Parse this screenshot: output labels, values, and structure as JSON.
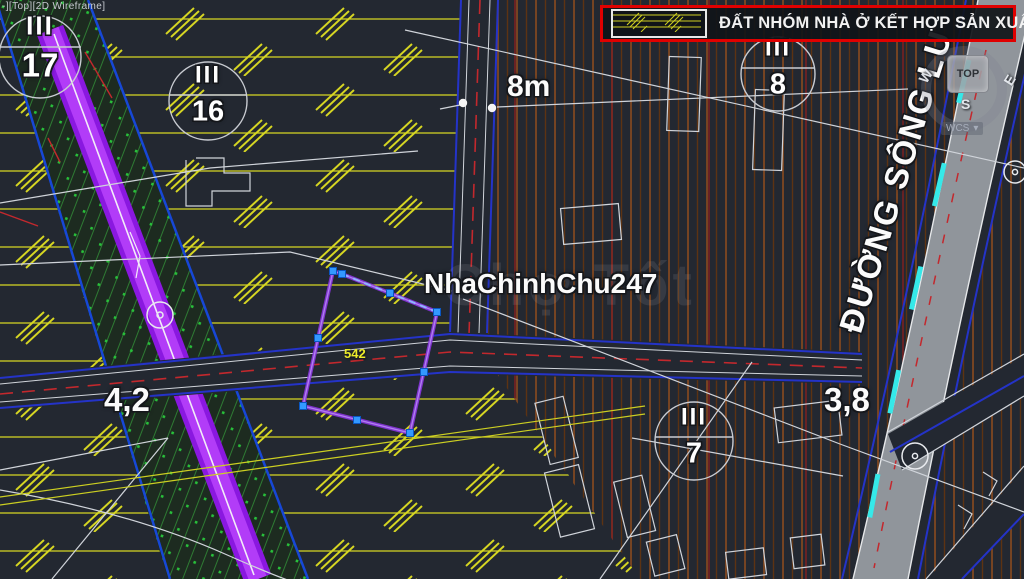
{
  "viewport": {
    "label": "-][Top][2D Wireframe]"
  },
  "legend": {
    "title": "ĐẤT NHÓM NHÀ Ở KẾT HỢP SẢN XUẤT"
  },
  "viewcube": {
    "top_face": "TOP",
    "west": "W",
    "east": "E",
    "south": "S",
    "coord_system": "WCS",
    "dropdown_arrow": "▾"
  },
  "zones": [
    {
      "roman": "III",
      "number": "17"
    },
    {
      "roman": "III",
      "number": "16"
    },
    {
      "roman": "III",
      "number": "8"
    },
    {
      "roman": "III",
      "number": "7"
    }
  ],
  "labels": {
    "road_width_dim": "8m",
    "lot_number": "542",
    "dim_left": "4,2",
    "dim_right": "3,8",
    "advertiser": "NhaChinhChu247",
    "site_watermark": "Chợ Tốt",
    "road_name": "ĐƯỜNG SÔNG LU"
  },
  "colors": {
    "background": "#232831",
    "legend_border": "#e00000",
    "residential_production_hatch": "#d6d622",
    "planned_road_purple": "#b23cf8",
    "green_zone_dots": "#28c03a",
    "road_edge_blue": "#2433c8",
    "centerline_red": "#c3282d",
    "road_marking_cyan": "#35e9e9",
    "selection_grip": "#3399ff",
    "parcel_selection": "#8a35e0",
    "paved_road_gray": "#90959b"
  }
}
